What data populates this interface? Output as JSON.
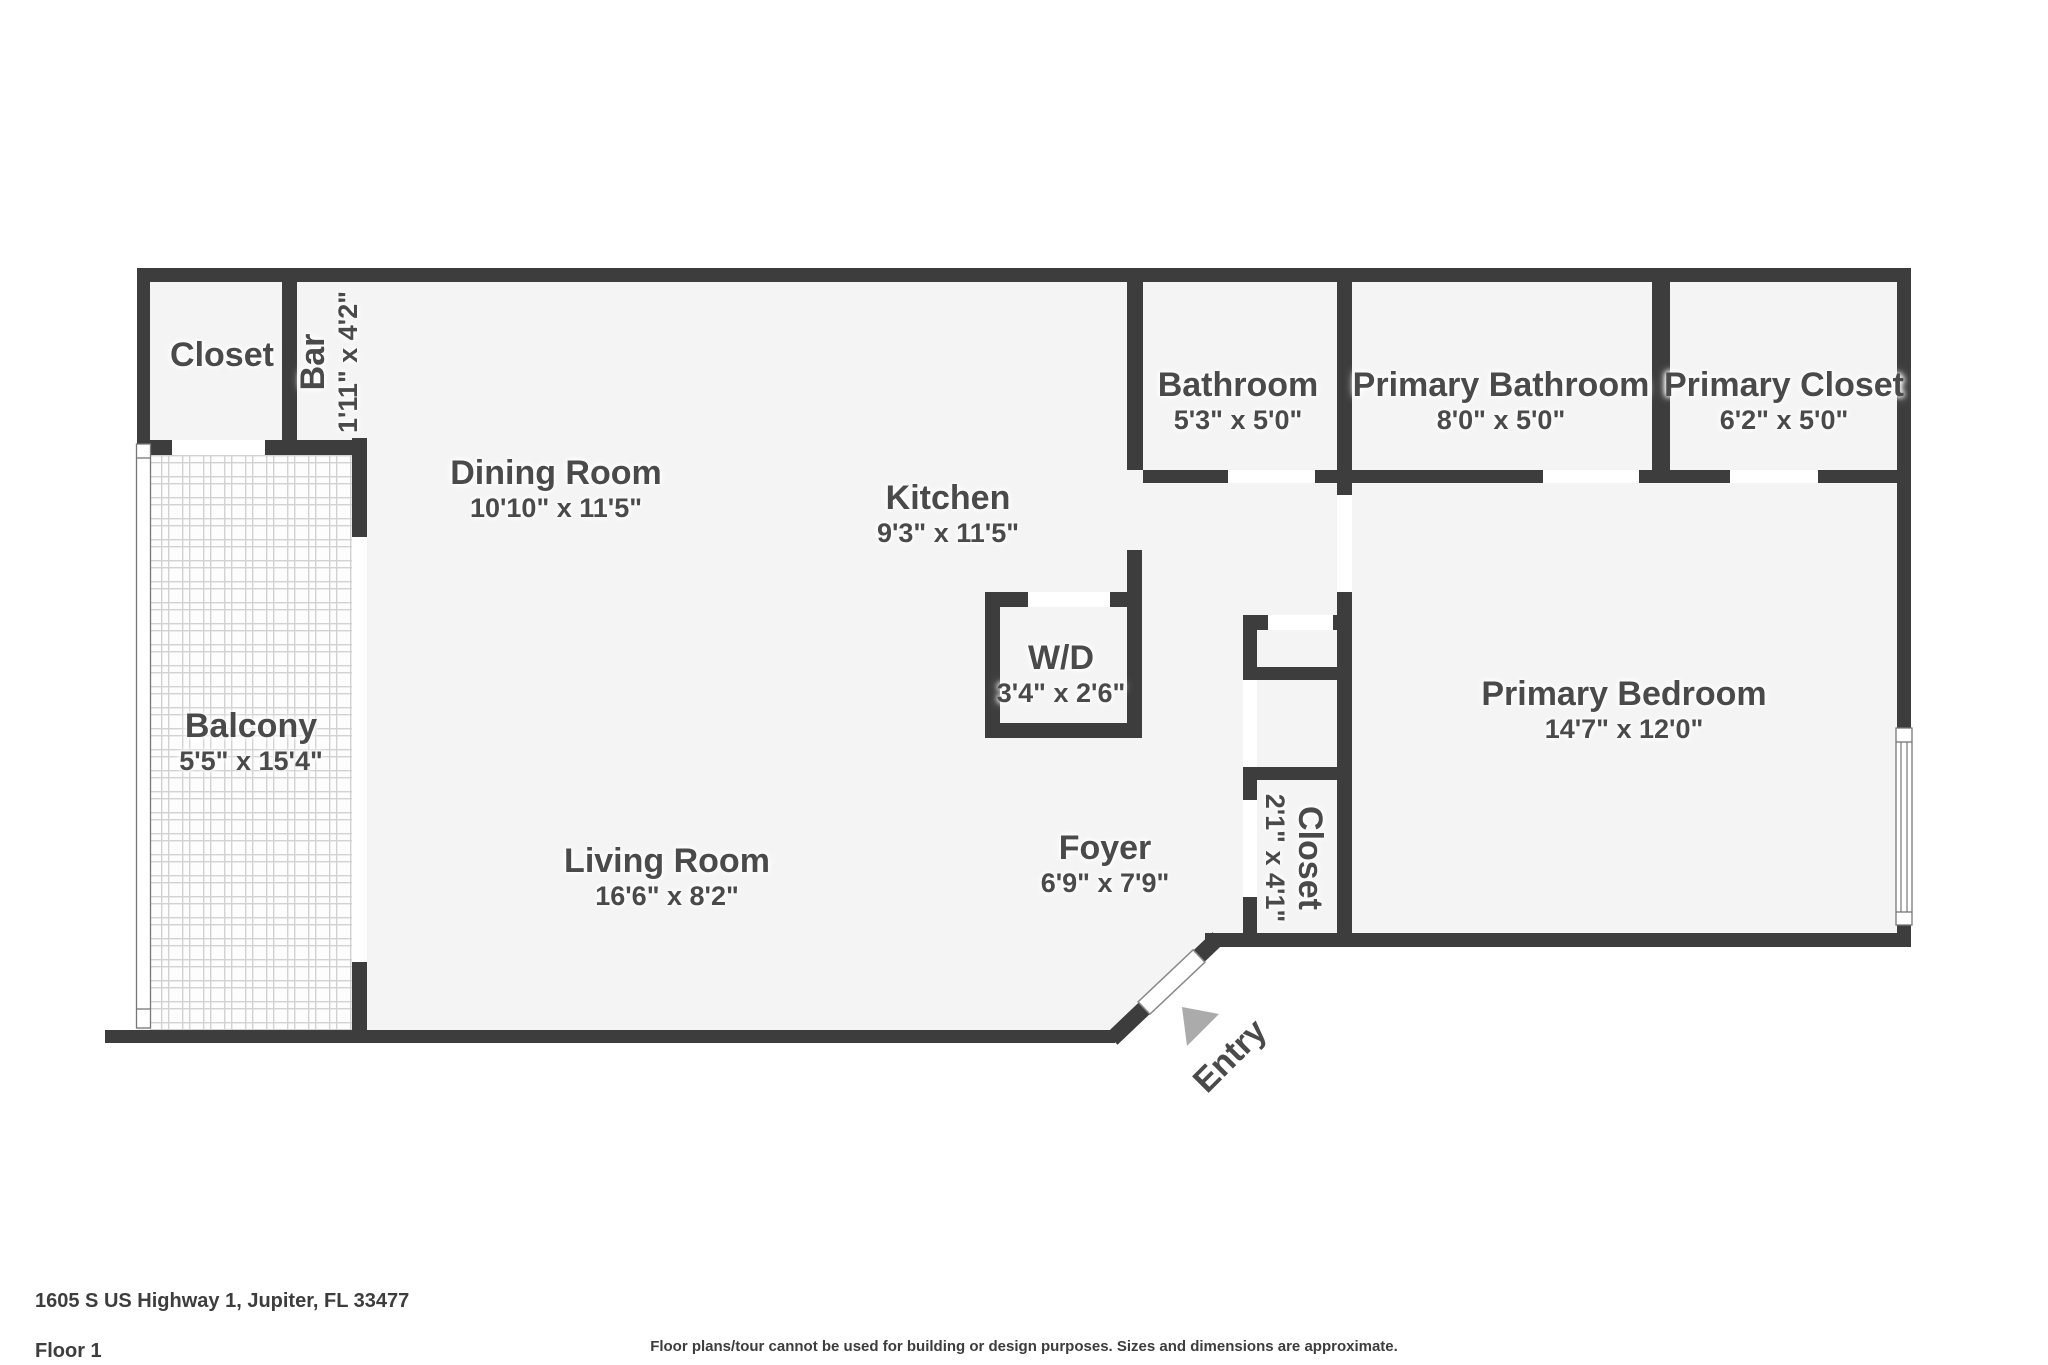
{
  "plan_title": "Floor plan",
  "colors": {
    "wall": "#3d3d3d",
    "room_fill": "#f4f4f4",
    "label_text": "#4a4a4a",
    "entry_arrow": "#ababab",
    "tile_line": "#d2d2d2"
  },
  "rooms": {
    "closet_tl": {
      "name": "Closet"
    },
    "bar": {
      "name": "Bar",
      "dims": "1'11\" x 4'2\""
    },
    "dining": {
      "name": "Dining Room",
      "dims": "10'10\" x 11'5\""
    },
    "kitchen": {
      "name": "Kitchen",
      "dims": "9'3\" x 11'5\""
    },
    "bathroom": {
      "name": "Bathroom",
      "dims": "5'3\" x 5'0\""
    },
    "primary_bathroom": {
      "name": "Primary Bathroom",
      "dims": "8'0\" x 5'0\""
    },
    "primary_closet": {
      "name": "Primary Closet",
      "dims": "6'2\" x 5'0\""
    },
    "balcony": {
      "name": "Balcony",
      "dims": "5'5\" x 15'4\""
    },
    "wd": {
      "name": "W/D",
      "dims": "3'4\" x 2'6\""
    },
    "living": {
      "name": "Living Room",
      "dims": "16'6\" x 8'2\""
    },
    "foyer": {
      "name": "Foyer",
      "dims": "6'9\" x 7'9\""
    },
    "closet_foyer": {
      "name": "Closet",
      "dims": "2'1\" x 4'1\""
    },
    "primary_bedroom": {
      "name": "Primary Bedroom",
      "dims": "14'7\" x 12'0\""
    }
  },
  "entry": {
    "label": "Entry"
  },
  "footer": {
    "address": "1605 S US Highway 1, Jupiter, FL 33477",
    "floor": "Floor 1",
    "disclaimer": "Floor plans/tour cannot be used for building or design purposes. Sizes and dimensions are approximate."
  }
}
